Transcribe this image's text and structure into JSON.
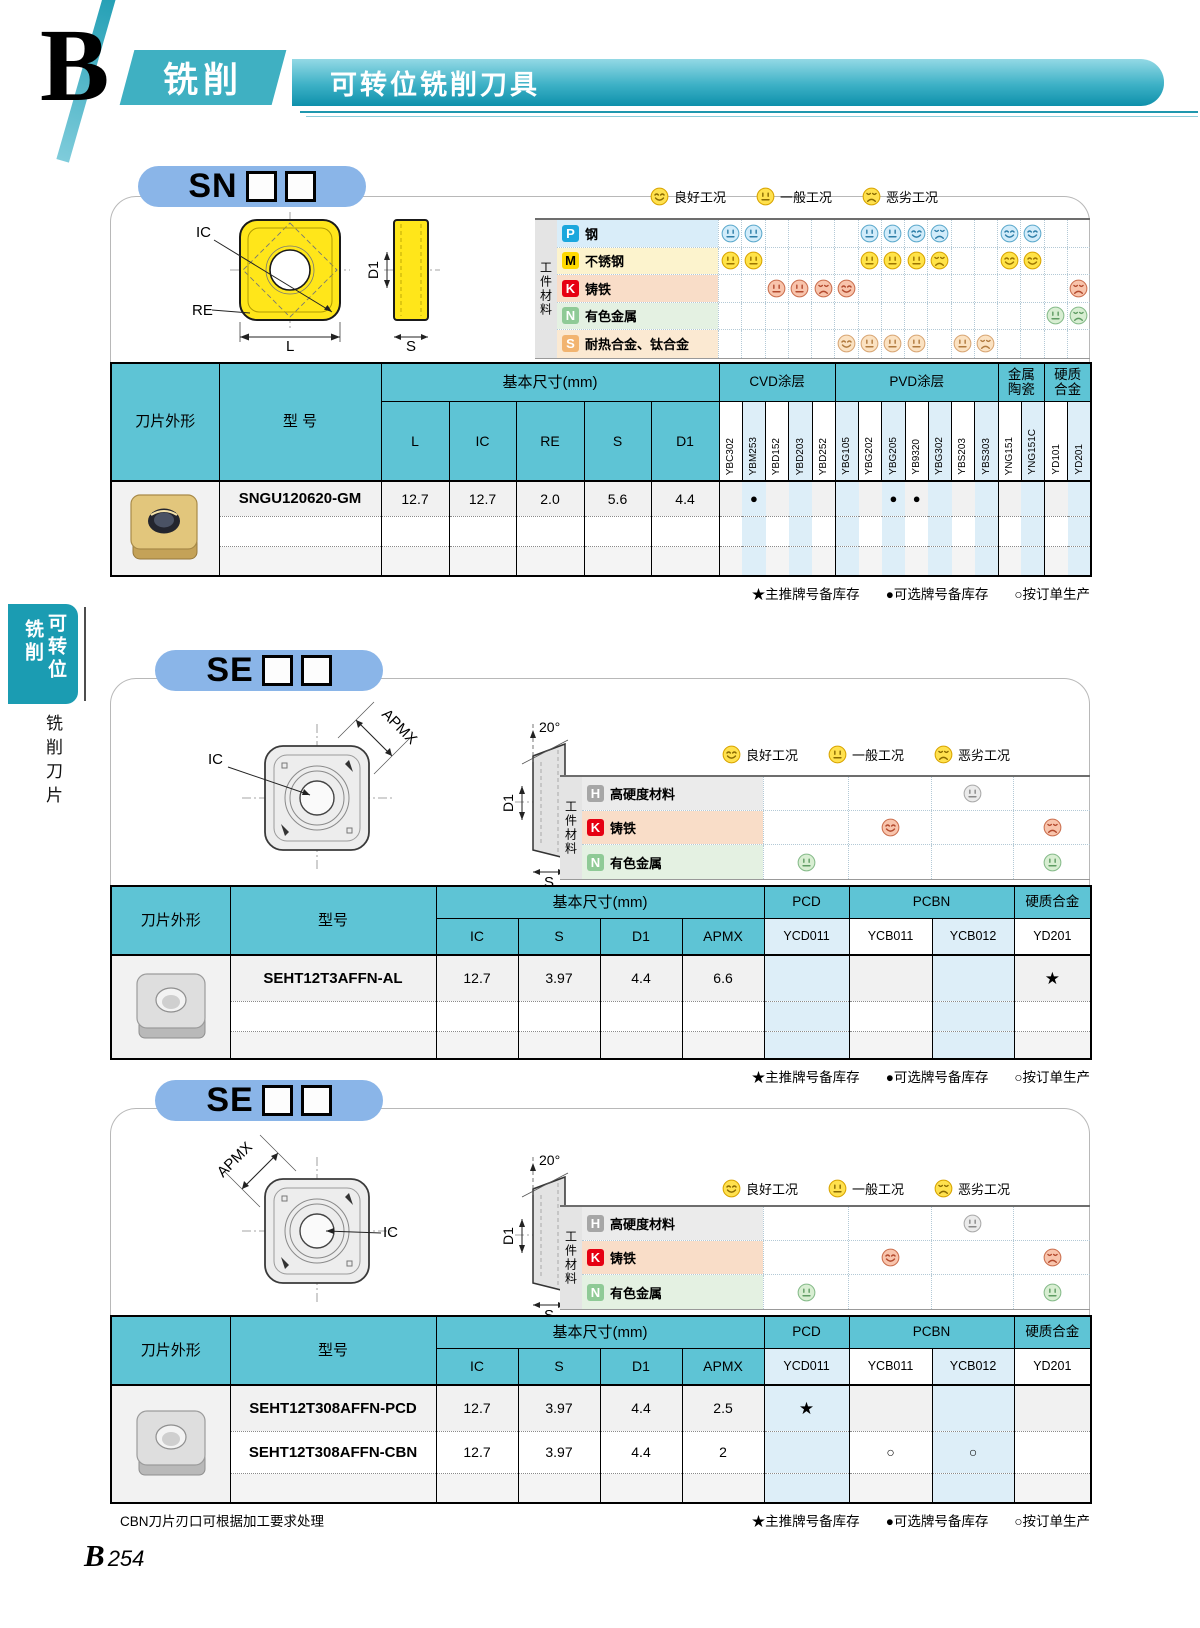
{
  "header": {
    "letter": "B",
    "category": "铣削",
    "title": "可转位铣削刀具"
  },
  "sidebar": {
    "tab_right": "可转位",
    "tab_left": "铣削",
    "below": "铣削刀片"
  },
  "material_axis": "工件材料",
  "legend": [
    {
      "kind": "good",
      "label": "良好工况"
    },
    {
      "kind": "fair",
      "label": "一般工况"
    },
    {
      "kind": "poor",
      "label": "恶劣工况"
    }
  ],
  "footnote": [
    "★主推牌号备库存",
    "●可选牌号备库存",
    "○按订单生产"
  ],
  "page_number": {
    "letter": "B",
    "digits": "254"
  },
  "colors": {
    "banner_teal": "#1095ae",
    "tab_teal": "#1b9cb2",
    "pill_blue": "#8ab5e8",
    "header_cyan": "#5ec4d5",
    "column_tint": "#ddeef8",
    "badge_p": "#1ba7dd",
    "badge_m": "#ffd900",
    "badge_k": "#e60012",
    "badge_n": "#8fca96",
    "badge_s": "#f2b470",
    "badge_h": "#a6a6a6"
  },
  "sections": [
    {
      "code": "SN",
      "boxes": 2,
      "diagram": {
        "type": "sn",
        "ic": "IC",
        "re": "RE",
        "l": "L",
        "d1": "D1",
        "s": "S"
      },
      "materials": [
        {
          "code": "P",
          "name": "钢",
          "theme": "p",
          "ratings": {
            "0": "fair",
            "1": "fair",
            "6": "fair",
            "7": "fair",
            "8": "good",
            "9": "poor",
            "12": "good",
            "13": "good"
          }
        },
        {
          "code": "M",
          "name": "不锈钢",
          "theme": "m",
          "ratings": {
            "0": "fair",
            "1": "fair",
            "6": "fair",
            "7": "fair",
            "8": "fair",
            "9": "poor",
            "12": "good",
            "13": "good"
          }
        },
        {
          "code": "K",
          "name": "铸铁",
          "theme": "k",
          "ratings": {
            "2": "fair",
            "3": "fair",
            "4": "poor",
            "5": "good",
            "15": "poor"
          }
        },
        {
          "code": "N",
          "name": "有色金属",
          "theme": "n",
          "ratings": {
            "14": "fair",
            "15": "poor"
          }
        },
        {
          "code": "S",
          "name": "耐热合金、钛合金",
          "theme": "s",
          "ratings": {
            "5": "good",
            "6": "fair",
            "7": "fair",
            "8": "fair",
            "10": "fair",
            "11": "poor"
          }
        }
      ],
      "table": {
        "shape_header": "刀片外形",
        "model_header": "型 号",
        "dims_header": "基本尺寸(mm)",
        "dim_cols": [
          "L",
          "IC",
          "RE",
          "S",
          "D1"
        ],
        "groups": [
          {
            "label": "CVD涂层",
            "cols": [
              {
                "n": "YBC302",
                "t": 0
              },
              {
                "n": "YBM253",
                "t": 1
              },
              {
                "n": "YBD152",
                "t": 0
              },
              {
                "n": "YBD203",
                "t": 1
              },
              {
                "n": "YBD252",
                "t": 0
              }
            ]
          },
          {
            "label": "PVD涂层",
            "cols": [
              {
                "n": "YBG105",
                "t": 1
              },
              {
                "n": "YBG202",
                "t": 0
              },
              {
                "n": "YBG205",
                "t": 1
              },
              {
                "n": "YB9320",
                "t": 0
              },
              {
                "n": "YBG302",
                "t": 1
              },
              {
                "n": "YBS203",
                "t": 0
              },
              {
                "n": "YBS303",
                "t": 1
              }
            ]
          },
          {
            "label": "金属\n陶瓷",
            "cols": [
              {
                "n": "YNG151",
                "t": 0
              },
              {
                "n": "YNG151C",
                "t": 1
              }
            ]
          },
          {
            "label": "硬质\n合金",
            "cols": [
              {
                "n": "YD101",
                "t": 0
              },
              {
                "n": "YD201",
                "t": 1
              }
            ]
          }
        ],
        "rows": [
          {
            "model": "SNGU120620-GM",
            "dims": [
              "12.7",
              "12.7",
              "2.0",
              "5.6",
              "4.4"
            ],
            "marks": {
              "YBM253": "●",
              "YBG205": "●",
              "YB9320": "●"
            }
          },
          {
            "model": "",
            "dims": [
              "",
              "",
              "",
              "",
              ""
            ],
            "marks": {}
          },
          {
            "model": "",
            "dims": [
              "",
              "",
              "",
              "",
              ""
            ],
            "marks": {}
          }
        ]
      }
    },
    {
      "code": "SE",
      "boxes": 2,
      "diagram": {
        "type": "se",
        "apmx": "APMX",
        "ic": "IC",
        "angle": "20°",
        "d1": "D1",
        "s": "S"
      },
      "materials": [
        {
          "code": "H",
          "name": "高硬度材料",
          "theme": "h",
          "ratings": {
            "2": "fair"
          }
        },
        {
          "code": "K",
          "name": "铸铁",
          "theme": "k",
          "ratings": {
            "1": "good",
            "3": "poor"
          }
        },
        {
          "code": "N",
          "name": "有色金属",
          "theme": "n",
          "ratings": {
            "0": "fair",
            "3": "fair"
          }
        }
      ],
      "table": {
        "shape_header": "刀片外形",
        "model_header": "型号",
        "dims_header": "基本尺寸(mm)",
        "dim_cols": [
          "IC",
          "S",
          "D1",
          "APMX"
        ],
        "groups": [
          {
            "label": "PCD",
            "cols": [
              {
                "n": "YCD011",
                "t": 1
              }
            ]
          },
          {
            "label": "PCBN",
            "cols": [
              {
                "n": "YCB011",
                "t": 0
              },
              {
                "n": "YCB012",
                "t": 1
              }
            ]
          },
          {
            "label": "硬质合金",
            "cols": [
              {
                "n": "YD201",
                "t": 0
              }
            ]
          }
        ],
        "rows": [
          {
            "model": "SEHT12T3AFFN-AL",
            "dims": [
              "12.7",
              "3.97",
              "4.4",
              "6.6"
            ],
            "marks": {
              "YD201": "★"
            }
          },
          {
            "model": "",
            "dims": [
              "",
              "",
              "",
              ""
            ],
            "marks": {}
          },
          {
            "model": "",
            "dims": [
              "",
              "",
              "",
              ""
            ],
            "marks": {}
          }
        ]
      }
    },
    {
      "code": "SE",
      "boxes": 2,
      "diagram": {
        "type": "se-mirror",
        "apmx": "APMX",
        "ic": "IC",
        "angle": "20°",
        "d1": "D1",
        "s": "S"
      },
      "note": "CBN刀片刃口可根据加工要求处理",
      "materials": [
        {
          "code": "H",
          "name": "高硬度材料",
          "theme": "h",
          "ratings": {
            "2": "fair"
          }
        },
        {
          "code": "K",
          "name": "铸铁",
          "theme": "k",
          "ratings": {
            "1": "good",
            "3": "poor"
          }
        },
        {
          "code": "N",
          "name": "有色金属",
          "theme": "n",
          "ratings": {
            "0": "fair",
            "3": "fair"
          }
        }
      ],
      "table": {
        "shape_header": "刀片外形",
        "model_header": "型号",
        "dims_header": "基本尺寸(mm)",
        "dim_cols": [
          "IC",
          "S",
          "D1",
          "APMX"
        ],
        "groups": [
          {
            "label": "PCD",
            "cols": [
              {
                "n": "YCD011",
                "t": 1
              }
            ]
          },
          {
            "label": "PCBN",
            "cols": [
              {
                "n": "YCB011",
                "t": 0
              },
              {
                "n": "YCB012",
                "t": 1
              }
            ]
          },
          {
            "label": "硬质合金",
            "cols": [
              {
                "n": "YD201",
                "t": 0
              }
            ]
          }
        ],
        "rows": [
          {
            "model": "SEHT12T308AFFN-PCD",
            "dims": [
              "12.7",
              "3.97",
              "4.4",
              "2.5"
            ],
            "marks": {
              "YCD011": "★"
            }
          },
          {
            "model": "SEHT12T308AFFN-CBN",
            "dims": [
              "12.7",
              "3.97",
              "4.4",
              "2"
            ],
            "marks": {
              "YCB011": "○",
              "YCB012": "○"
            }
          },
          {
            "model": "",
            "dims": [
              "",
              "",
              "",
              ""
            ],
            "marks": {}
          }
        ]
      }
    }
  ]
}
